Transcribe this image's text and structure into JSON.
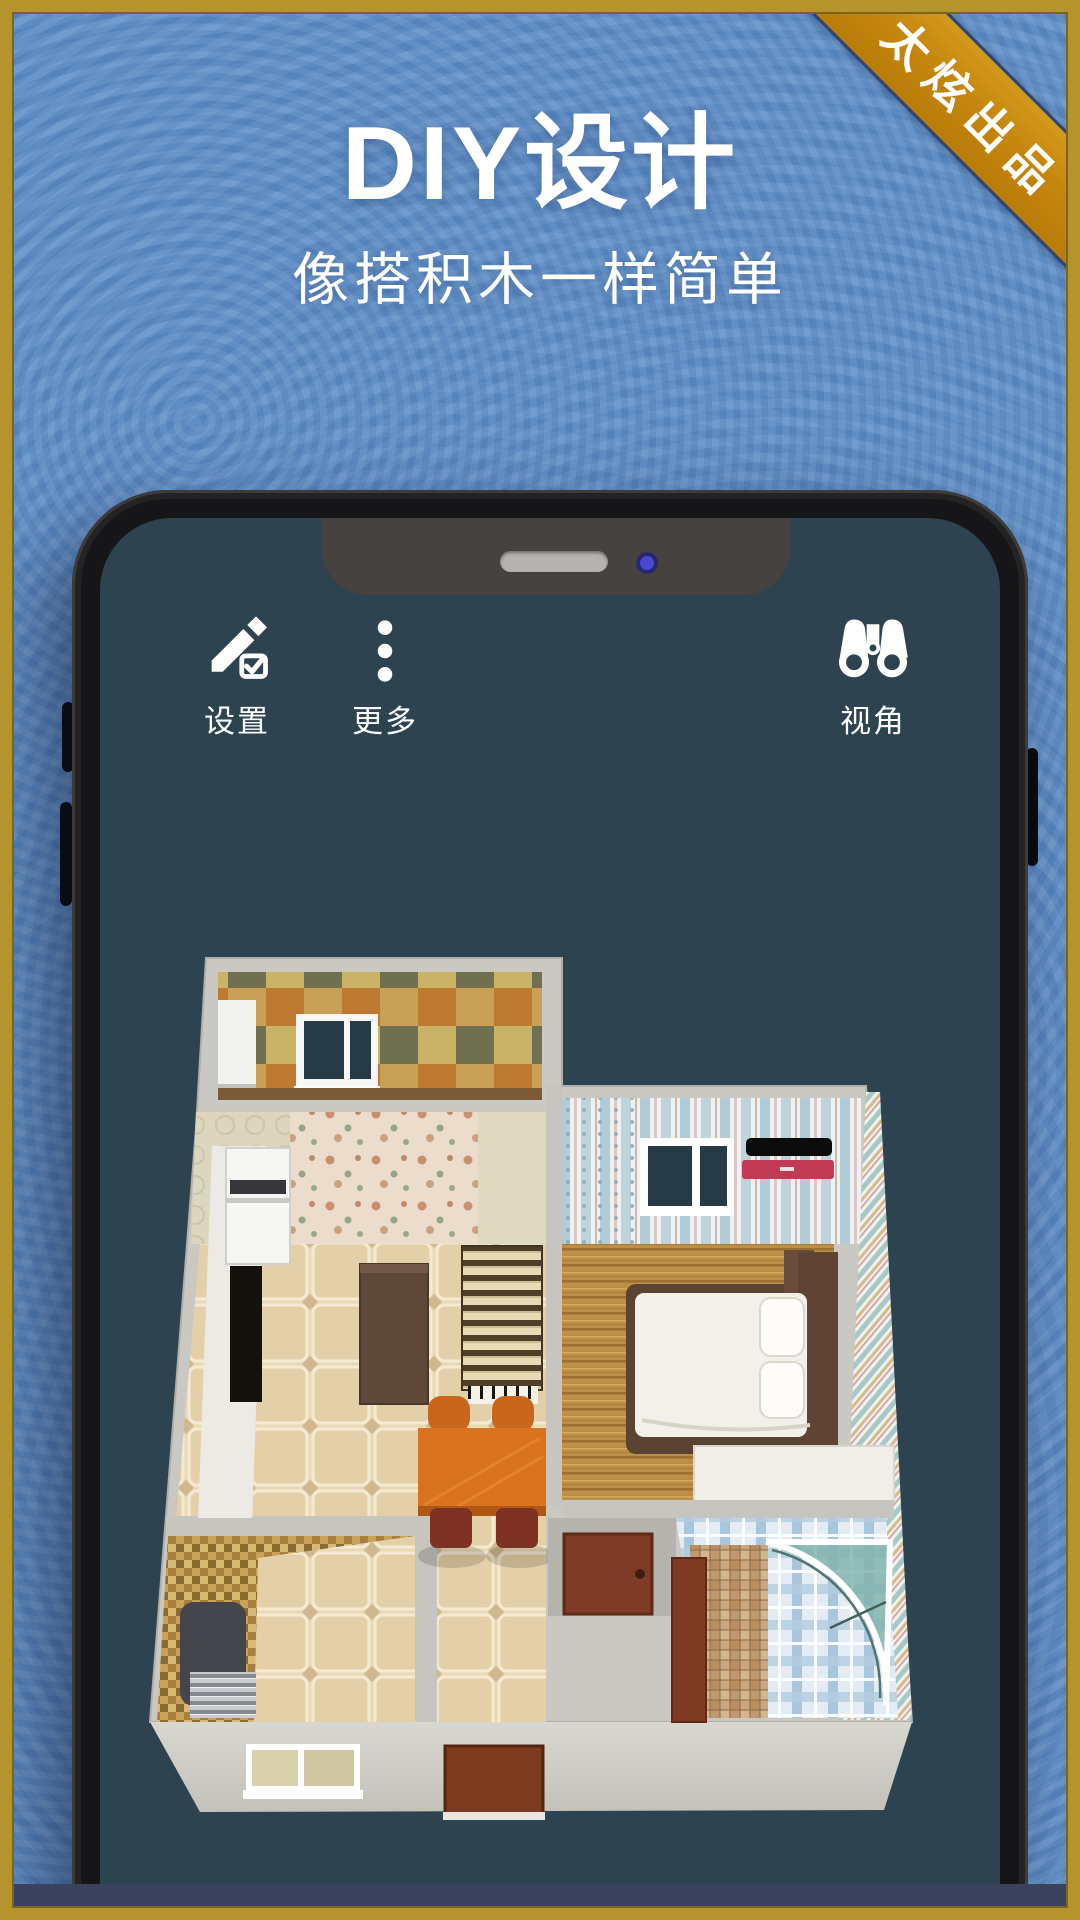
{
  "ribbon": {
    "label": "太炫出品"
  },
  "hero": {
    "title": "DIY设计",
    "subtitle": "像搭积木一样简单"
  },
  "phone": {
    "toolbar": {
      "settings": {
        "label": "设置",
        "icon": "pencil-edit-icon"
      },
      "more": {
        "label": "更多",
        "icon": "more-dots-icon"
      },
      "view": {
        "label": "视角",
        "icon": "binoculars-icon"
      }
    }
  },
  "colors": {
    "background_blue": "#5d8dc6",
    "frame_gold": "#b5942e",
    "ribbon_gold": "#c6870e",
    "screen_teal": "#2d4350",
    "table_orange": "#d9731f",
    "aircon_red": "#c23a55"
  }
}
